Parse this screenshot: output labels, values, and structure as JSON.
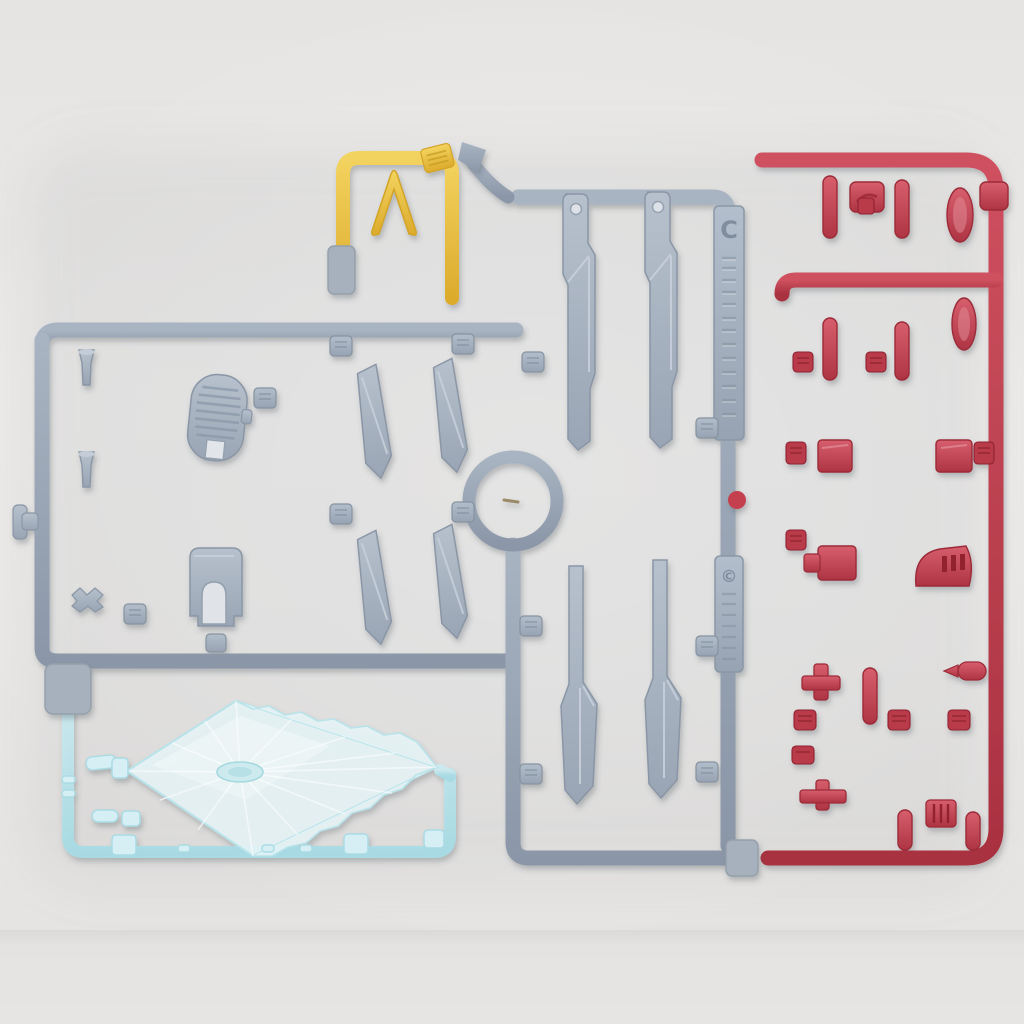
{
  "photo": {
    "subject": "Top-down photograph of plastic model kit runner sprues with unassembled parts",
    "background_hex": "#e9e7e5"
  },
  "tags": {
    "runner_letter": "C",
    "copyright_mark": "©"
  },
  "runners": {
    "gray": {
      "color_name": "blue-gray",
      "hex": "#97a3b3",
      "id_tag_letter": "C",
      "copyright_tag_mark": "©",
      "notable_parts": [
        "long leg frame part x2 (round pivot hole at top)",
        "long tapered blade part x2",
        "angled wing fin x4",
        "vented oval panel",
        "arched box block",
        "thruster cone x2",
        "assorted small joint parts and embossed part-number tabs"
      ]
    },
    "red": {
      "color_name": "red",
      "hex": "#c23c4c",
      "notable_parts": [
        "small armor squares x2",
        "spindle/cylinder parts x6",
        "oval pod parts x2",
        "arched vent part",
        "T-shaped joint parts x2",
        "ribbed connector",
        "embossed part-number tabs"
      ]
    },
    "yellow": {
      "color_name": "yellow",
      "hex": "#eec647",
      "notable_parts": [
        "V-fin antenna"
      ]
    },
    "clear_blue": {
      "color_name": "clear light blue",
      "hex": "#bfe6ec",
      "notable_parts": [
        "large diamond-shaped clear effect part with radiating facets and serrated edges",
        "small clear joint parts"
      ]
    }
  }
}
